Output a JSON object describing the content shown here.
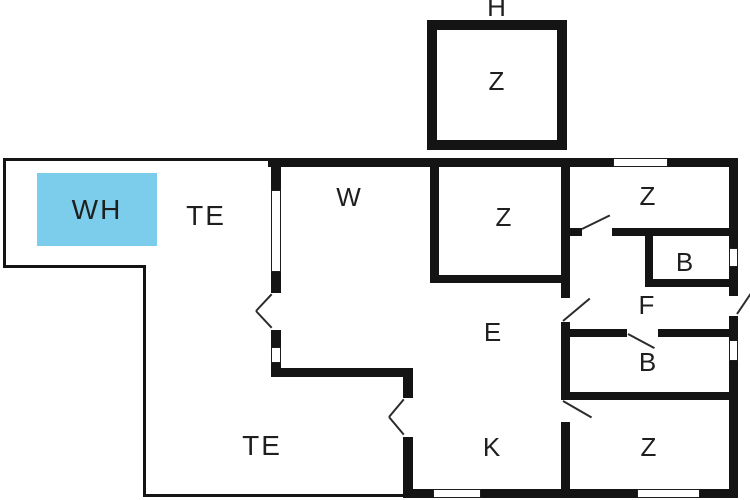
{
  "type": "floor-plan",
  "colors": {
    "background": "#ffffff",
    "wall": "#141414",
    "door_swing": "#2b2b2b",
    "highlight_fill": "#7ccdec",
    "label": "#1f1f1f"
  },
  "labels": {
    "annex_title": "H",
    "annex_room": "Z",
    "living_room": "W",
    "terrace_upper": "TE",
    "terrace_lower": "TE",
    "highlight_box": "WH",
    "bedroom_middle": "Z",
    "bedroom_top_right": "Z",
    "bathroom_small": "B",
    "hallway": "F",
    "bathroom_main": "B",
    "entry_hall": "E",
    "kitchen": "K",
    "bedroom_bottom_right": "Z"
  }
}
